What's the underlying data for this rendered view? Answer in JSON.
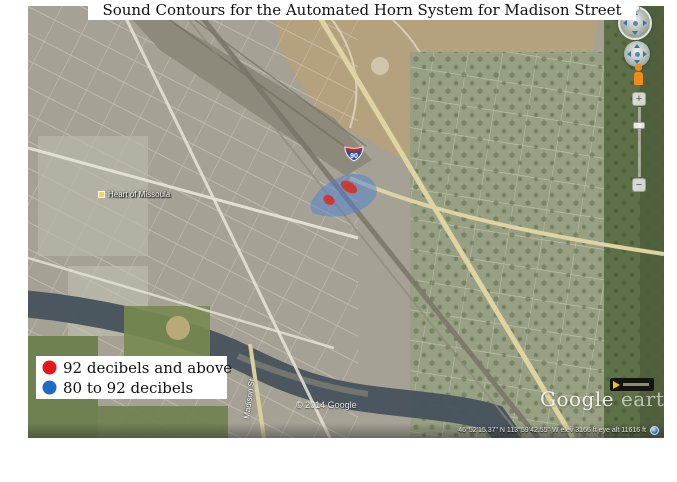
{
  "title": "Sound Contours for the Automated Horn System for Madison Street",
  "legend": {
    "items": [
      {
        "label": "92 decibels and above",
        "color": "#e8161f"
      },
      {
        "label": "80 to 92 decibels",
        "color": "#1d6cc4"
      }
    ]
  },
  "map": {
    "labels": {
      "place": "Heart of Missoula",
      "street": "Madison St",
      "copyright": "© 2014 Google",
      "watermark_google": "Google ",
      "watermark_earth": "earth",
      "status": "46°52'15.37\" N  113°59'42.55\" W   elev  3166 ft   eye alt  11616 ft",
      "interstate_number": "90"
    },
    "contour_colors": {
      "above_92": "#d92b1c",
      "band_80_92": "#4d7fd2"
    }
  },
  "controls": {
    "zoom_in_glyph": "+",
    "zoom_out_glyph": "−"
  }
}
